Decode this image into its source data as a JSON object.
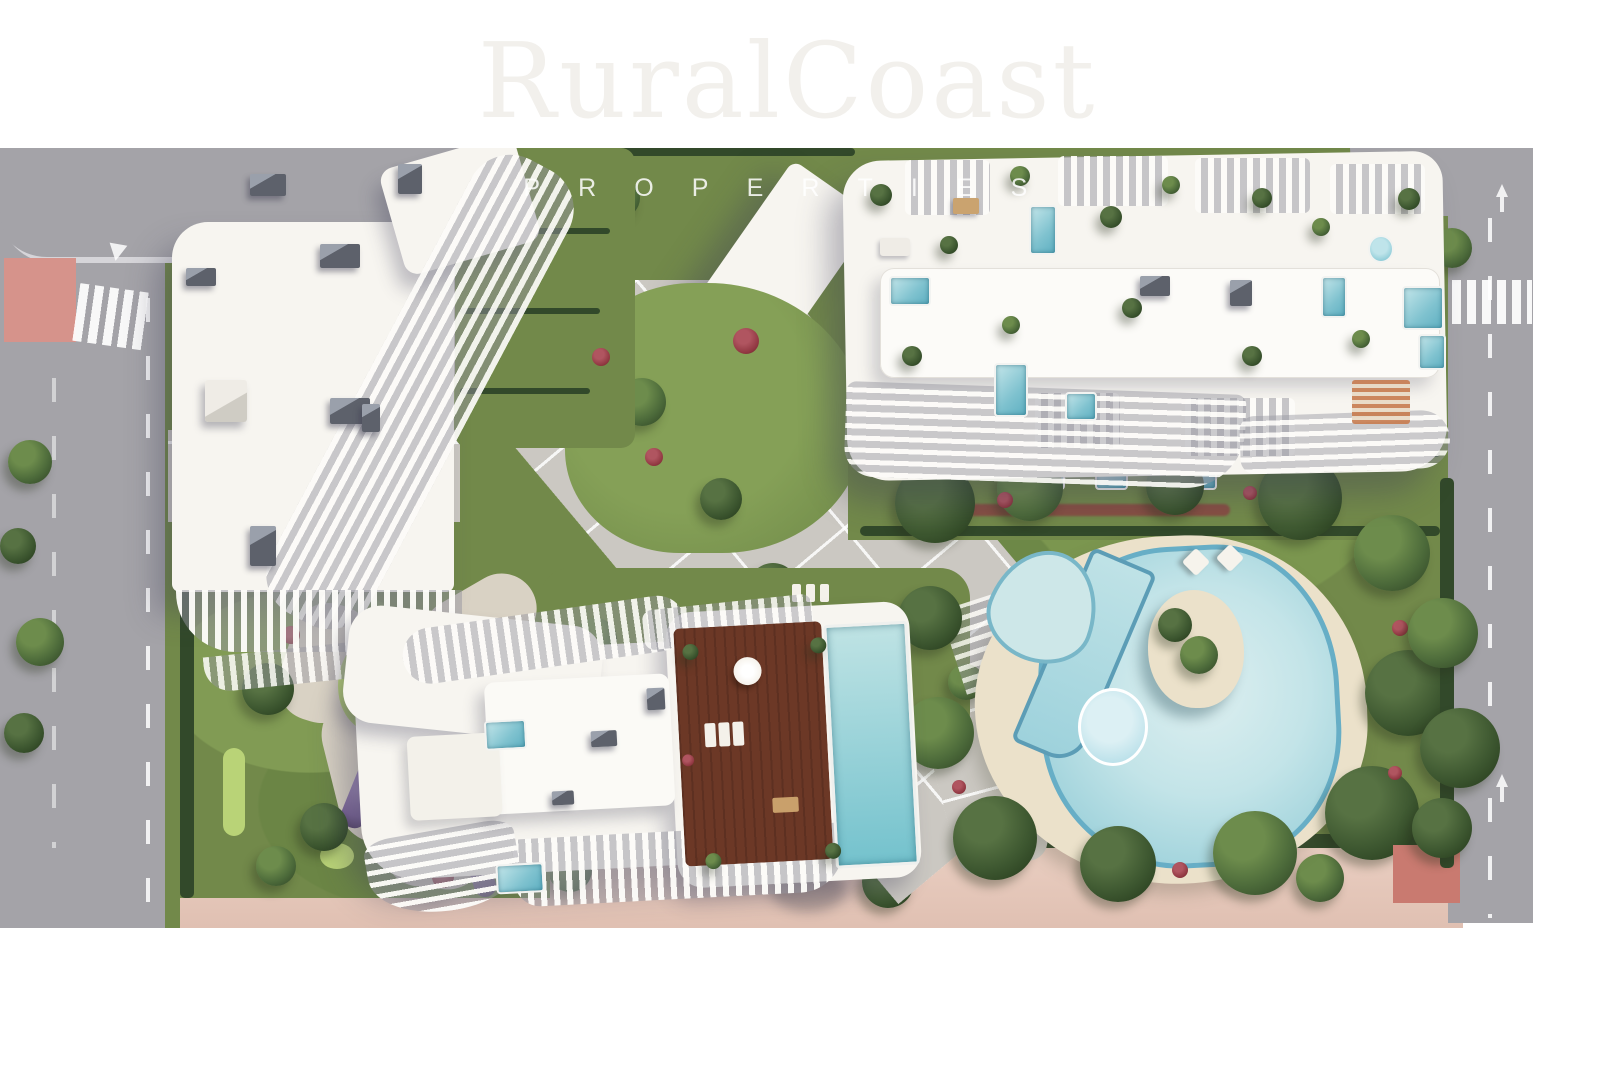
{
  "watermark": {
    "brand": "RuralCoast",
    "tagline": "PROPERTIES"
  },
  "palette": {
    "page_bg": "#ffffff",
    "road": "#a4a3a8",
    "road_light": "#c6c4c8",
    "sidewalk_pink": "#e9cec1",
    "red_pavement": "#d6938b",
    "red_patch": "#c97a70",
    "building_white": "#f7f5f0",
    "building_shade": "#e4e1da",
    "roof_gray": "#5d616b",
    "plaza": "#cbc8c2",
    "lawn": "#72894a",
    "lawn_light": "#93ab5e",
    "golf_green": "#b9d377",
    "hedge": "#32492a",
    "foliage": "#4c6a3a",
    "foliage_light": "#6d8c4c",
    "flower_red": "#8f3640",
    "flower_purple": "#6c5390",
    "pool_edge": "#67aec6",
    "pool_fill": "#8cc6d4",
    "pool_pale": "#d2ebec",
    "deck_sand": "#ebe1ca",
    "wood_deck": "#6c3826",
    "watermark_brand": "#f2f0ec",
    "watermark_tagline": "rgba(255,255,255,0.85)"
  }
}
